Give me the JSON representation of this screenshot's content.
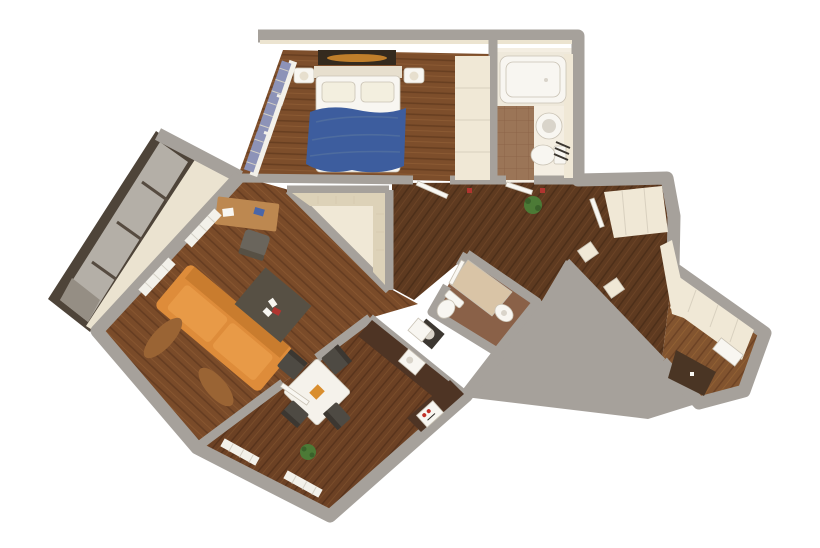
{
  "scene": {
    "type": "3d-apartment-floor-plan-render",
    "view": "top-down-perspective",
    "background": "#ffffff"
  },
  "palette": {
    "wall": "#a6a19b",
    "wallInner": "#ebe3d0",
    "floorBedroom": "#7d4e2b",
    "floorBedroomDark": "#683f21",
    "floorBedroomLight": "#8e5c34",
    "floorLiving": "#7a4b29",
    "floorLivingDark": "#663d21",
    "floorLivingLight": "#8a5831",
    "floorHall": "#5e3a20",
    "floorHallDark": "#4d2f19",
    "floorHallLight": "#6f4627",
    "floorDining": "#6c4124",
    "floorDiningDark": "#59341c",
    "floorDiningLight": "#7d4f2c",
    "floorEnd": "#82542f",
    "floorEndDark": "#6d4325",
    "floorEndLight": "#946334",
    "tileBath": "#9b7557",
    "tileBathLight": "#efe9db",
    "bathBase": "#f4eee2",
    "tileBath2": "#8a6148",
    "fixtureWhite": "#f8f6f1",
    "fixtureShadow": "#d9d4ca",
    "cream": "#f0e8d6",
    "creamShadow": "#ddd2b8",
    "balconyFrame": "#4e4439",
    "balconyGlass": "#b4afa7",
    "balconyGlassDark": "#958e84",
    "sofa": "#de8c3a",
    "sofaDark": "#c97c2e",
    "sofaLight": "#e89a47",
    "blanket": "#3d5d9e",
    "pillow": "#f3efdf",
    "headboard": "#e7dfce",
    "curtainBlue": "#8d93b8",
    "curtainWhite": "#f3f1ea",
    "curtainBrown": "#9a6434",
    "rug": "#575044",
    "desk": "#bd8850",
    "deskFolderBlue": "#4a66a8",
    "chairGray": "#6a655c",
    "table": "#f5f2eb",
    "chairDark": "#4e4a43",
    "counter": "#4e3424",
    "stoveRed": "#c03028",
    "plant": "#4c7a36",
    "plantDark": "#3a612a",
    "paintingBg": "#342a1e",
    "paintingSun": "#d98e2e",
    "door": "#f9f7f2",
    "shower": "#d9c4a6",
    "washerDark": "#3c3731",
    "accentRed": "#b03530",
    "matDark": "#4a3524"
  },
  "rooms": [
    {
      "id": "balcony-loggia"
    },
    {
      "id": "bedroom"
    },
    {
      "id": "bathroom-main"
    },
    {
      "id": "walk-in-closet"
    },
    {
      "id": "hallway"
    },
    {
      "id": "bathroom-small"
    },
    {
      "id": "living-room"
    },
    {
      "id": "dining-kitchen"
    },
    {
      "id": "corridor"
    },
    {
      "id": "storage-room"
    }
  ],
  "furniture": [
    "double-bed",
    "blue-blanket",
    "pillows",
    "nightstands",
    "wall-painting",
    "wardrobe",
    "bathtub",
    "wash-basin",
    "toilet",
    "towel-rack",
    "shower-cabin",
    "washing-machine",
    "orange-sofa",
    "coffee-rug",
    "playing-cards",
    "writing-desk",
    "office-chair",
    "dining-table",
    "dining-chairs",
    "kitchen-counter",
    "stove",
    "sink-unit",
    "window-curtains",
    "house-plants",
    "built-in-shelving",
    "cabinet-row",
    "floor-mat"
  ]
}
